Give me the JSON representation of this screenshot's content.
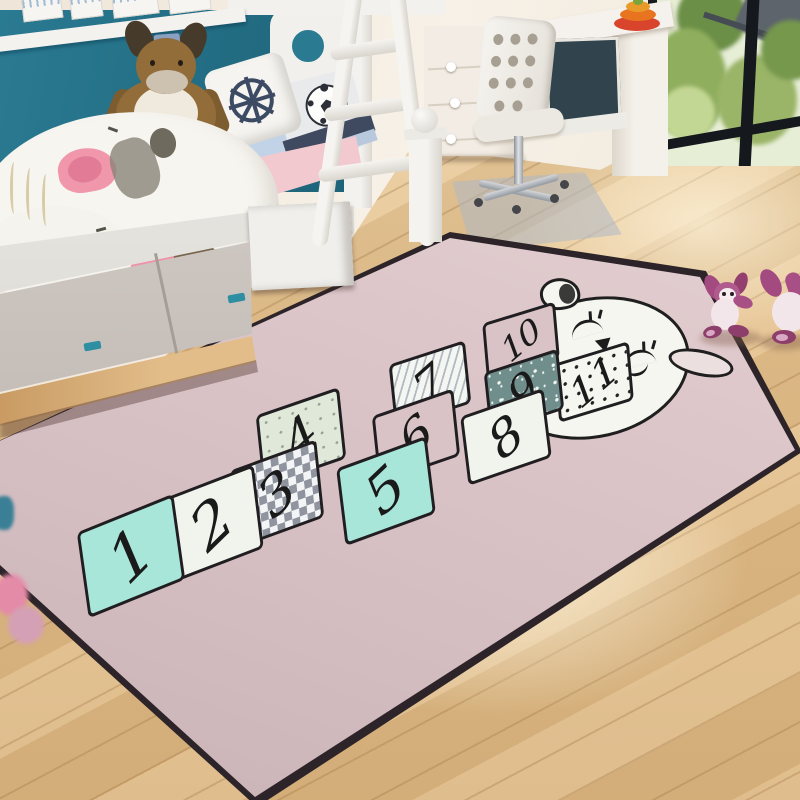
{
  "rug": {
    "style": "hopscotch play mat",
    "character": "sleeping-bunny-face",
    "cells": [
      {
        "label": "1",
        "pattern": "mint"
      },
      {
        "label": "2",
        "pattern": "cream"
      },
      {
        "label": "3",
        "pattern": "gray-diamond"
      },
      {
        "label": "4",
        "pattern": "sage-dots"
      },
      {
        "label": "5",
        "pattern": "mint"
      },
      {
        "label": "6",
        "pattern": "blush"
      },
      {
        "label": "7",
        "pattern": "gray-stripes"
      },
      {
        "label": "8",
        "pattern": "cream"
      },
      {
        "label": "9",
        "pattern": "teal-stars"
      },
      {
        "label": "10",
        "pattern": "blush"
      },
      {
        "label": "11",
        "pattern": "black-dots"
      }
    ],
    "colors": {
      "base": "#d9c3c7",
      "mint": "#a9e6da",
      "teal": "#6f8e8c",
      "outline": "#201e20"
    }
  },
  "room": {
    "objects": [
      "bunk-bed",
      "ladder",
      "plush-donkey",
      "ship-wheel-pillow",
      "soccer-pillow",
      "storage-drawers",
      "dresser",
      "desk",
      "monitor",
      "stacking-ring-toy",
      "desk-chair",
      "window-greenery",
      "wood-floor",
      "purple-bunny-toys",
      "pink-floor-toys"
    ],
    "colors": {
      "wall_teal": "#256e85",
      "floor_wood": "#e5c18d",
      "toy_magenta": "#a84f85",
      "mattress_pink": "#f2c9cf"
    }
  }
}
